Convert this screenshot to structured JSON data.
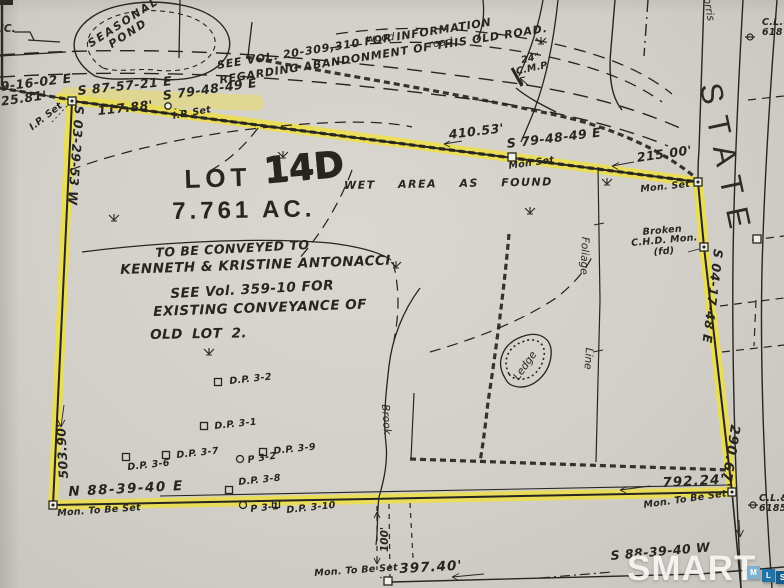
{
  "colors": {
    "paper": "#d2cfc8",
    "ink": "#26251f",
    "highlight": "#f0e03a",
    "watermark": "#f7f6f3",
    "mls_m": "#7fb1cf",
    "mls_l": "#2273a5",
    "mls_s": "#175c8b"
  },
  "lot": {
    "lot_word": "LOT",
    "lot_number": "14D",
    "acreage": "7.761 AC."
  },
  "notes": {
    "old_road_1": "SEE VOL. 20-309,310 FOR INFORMATION",
    "old_road_2": "REGARDING ABANDONMENT OF THIS OLD ROAD.",
    "wet_area": "WET AREA AS FOUND",
    "conveyed_1": "TO BE CONVEYED TO",
    "conveyed_2": "KENNETH & KRISTINE ANTONACCI",
    "conveyed_3": "SEE Vol. 359-10 FOR",
    "conveyed_4": "EXISTING CONVEYANCE OF",
    "conveyed_5": "OLD LOT 2."
  },
  "bearings": {
    "north_far_left": "9-16-02 E",
    "north_far_left_dist": "125.81'",
    "north_1": "S 87-57-21 E",
    "north_1_dist": "117.88'",
    "north_2": "S 79-48-49 E",
    "north_3_dist": "410.53'",
    "north_3": "S 79-48-49 E",
    "north_4_dist": "215.00'",
    "east": "S 04-17-48 E",
    "east_dist": "290.67'",
    "south": "N 88-39-40 E",
    "south_dist": "792.24'",
    "west": "S 03-29-53 W",
    "west_dist": "503.90'",
    "offsite_south": "S 88-39-40 W",
    "offsite_dist": "397.40'",
    "strip_width": "100'"
  },
  "monuments": {
    "ip_set_1": "I.P. Set",
    "ip_set_2": "I.P. Set",
    "mon_set_1": "Mon Set",
    "mon_set_2": "Mon. Set",
    "broken_1": "Broken",
    "broken_2": "C.H.D. Mon.",
    "broken_3": "(fd)",
    "mon_tbs_left": "Mon. To Be Set",
    "mon_tbs_right": "Mon. To Be Set",
    "mon_tbs_mid": "Mon. To Be Set"
  },
  "features": {
    "inc": "IC.",
    "seasonal_pond_1": "SEASONAL",
    "seasonal_pond_2": "POND",
    "wood": "wood",
    "road": "road",
    "morris": "Morris",
    "state": "STATE",
    "culvert_1": "24\"",
    "culvert_2": "C.M.P.",
    "pole_top_1": "C.L.&",
    "pole_top_2": "618",
    "pole_bottom_1": "C.L.&",
    "pole_bottom_2": "6185",
    "foliage": "Foliage",
    "foliage_line": "Line",
    "ledge": "Ledge",
    "brook": "Brook"
  },
  "test_pits": {
    "dp3_2": "D.P. 3-2",
    "dp3_1": "D.P. 3-1",
    "dp3_7": "D.P. 3-7",
    "dp3_6": "D.P. 3-6",
    "p3_2": "P 3-2",
    "dp3_9": "D.P. 3-9",
    "dp3_8": "D.P. 3-8",
    "p3_1": "P 3-1",
    "dp3_10": "D.P. 3-10"
  },
  "watermark": {
    "brand": "SMART",
    "m": "M",
    "l": "L",
    "s": "S"
  }
}
